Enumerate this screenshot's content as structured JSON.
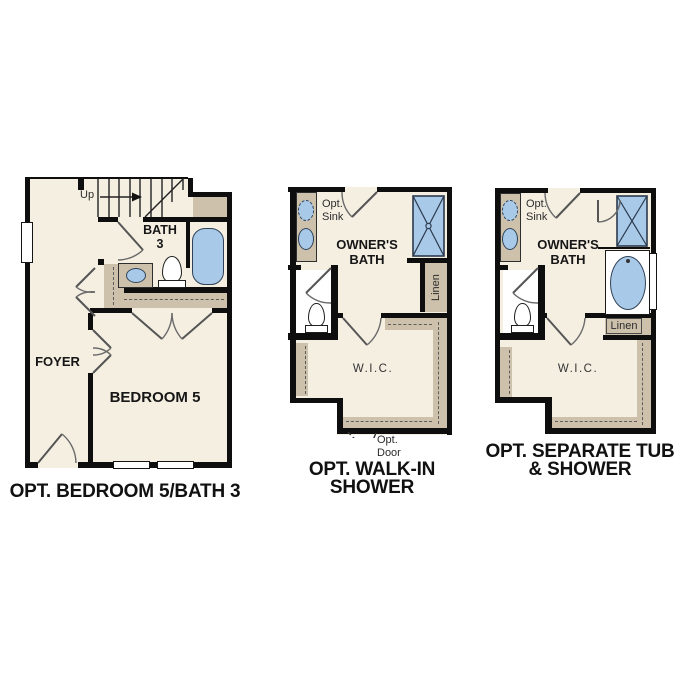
{
  "colors": {
    "floor_cream": "#f5efe2",
    "wall_black": "#0e0e0e",
    "counter_tan": "#cdc1ab",
    "fixture_blue": "#a9c9e8"
  },
  "plan1": {
    "caption": "OPT. BEDROOM 5/BATH 3",
    "stairs_label": "Up",
    "bath_label_line1": "BATH",
    "bath_label_line2": "3",
    "foyer_label": "FOYER",
    "bedroom_label": "BEDROOM 5"
  },
  "plan2": {
    "caption_line1": "OPT. WALK-IN",
    "caption_line2": "SHOWER",
    "opt_sink_line1": "Opt.",
    "opt_sink_line2": "Sink",
    "bath_label_line1": "OWNER'S",
    "bath_label_line2": "BATH",
    "linen_label": "Linen",
    "wic_label": "W.I.C.",
    "opt_door_line1": "Opt.",
    "opt_door_line2": "Door"
  },
  "plan3": {
    "caption_line1": "OPT. SEPARATE TUB",
    "caption_line2": "& SHOWER",
    "opt_sink_line1": "Opt.",
    "opt_sink_line2": "Sink",
    "bath_label_line1": "OWNER'S",
    "bath_label_line2": "BATH",
    "linen_label": "Linen",
    "wic_label": "W.I.C."
  }
}
